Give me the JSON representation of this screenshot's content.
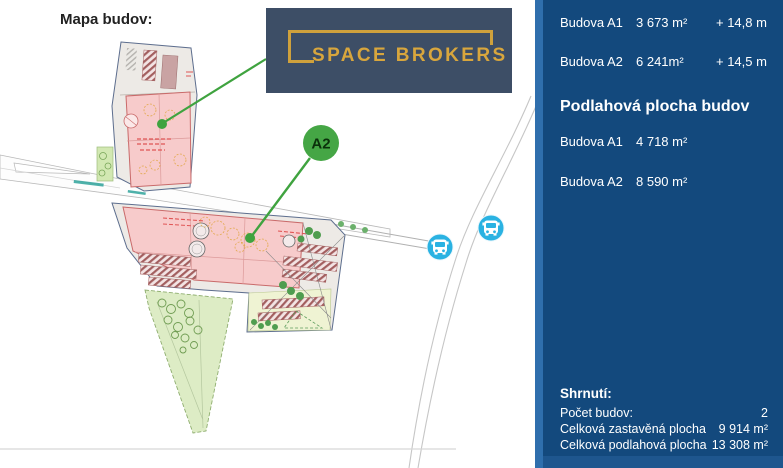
{
  "map": {
    "title": "Mapa budov:",
    "logo": {
      "text": "SPACE BROKERS",
      "bg_color": "#3d4e66",
      "gold_color": "#d8a63d"
    },
    "marker": {
      "label": "A2",
      "color": "#45a645"
    },
    "bus_stop_color": "#2ab2e2",
    "icons": [
      "bus-icon",
      "building-marker-icon"
    ]
  },
  "sidebar": {
    "bg_color": "#13497d",
    "stripe_color": "#2f6fad",
    "buildings_top": [
      {
        "name": "Budova A1",
        "area": "3 673 m²",
        "height": "+ 14,8 m"
      },
      {
        "name": "Budova A2",
        "area": "6 241m²",
        "height": "+ 14,5 m"
      }
    ],
    "floor_section": {
      "heading": "Podlahová plocha budov",
      "rows": [
        {
          "name": "Budova A1",
          "area": "4 718 m²"
        },
        {
          "name": "Budova A2",
          "area": "8 590 m²"
        }
      ]
    },
    "summary": {
      "heading": "Shrnutí:",
      "rows": [
        {
          "label": "Počet budov:",
          "value": "2"
        },
        {
          "label": "Celková zastavěná plocha",
          "value": "9 914 m²"
        },
        {
          "label": "Celková podlahová plocha",
          "value": "13 308 m²"
        }
      ]
    }
  }
}
